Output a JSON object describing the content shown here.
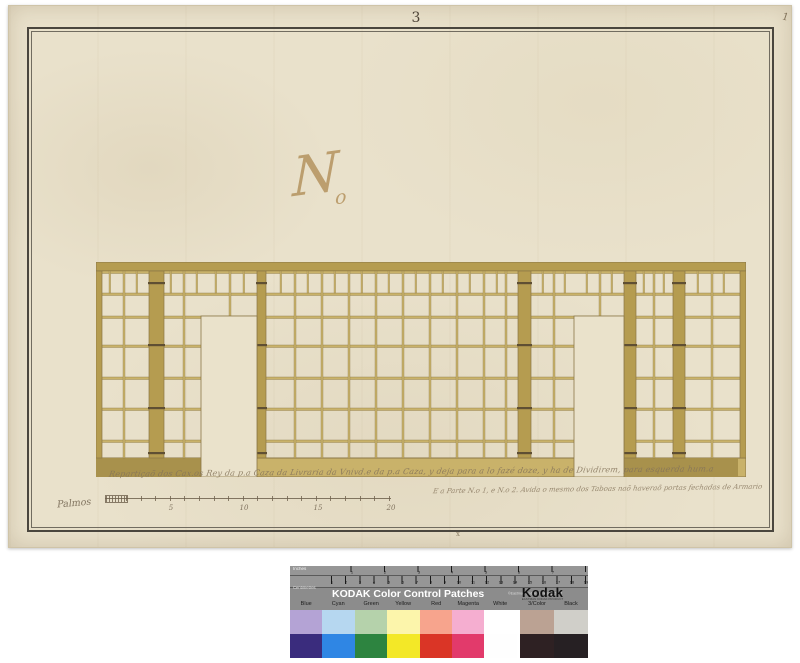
{
  "paper": {
    "page_number": "3",
    "corner_mark": "1",
    "monogram": {
      "main": "N",
      "sub": "o"
    },
    "caption_line1": "Repartiçaõ dos Cax.os Rey da p.a Caza da Livraria da Vnivd.e da p.a Caza, y deja para a lo fazé doze, y ha de Dividirem, para esquerda hum.a",
    "caption_line2": "E a Parte N.o 1, e N.o 2. Avida o mesmo dos Taboas naõ haveraõ portas fechadas de Armario",
    "bottom_mark": "x"
  },
  "scale_bar": {
    "label": "Palmos",
    "x0": 96,
    "x1": 382,
    "y": 492,
    "hatch": [
      96,
      117
    ],
    "tick_start": 117,
    "tick_spacing": 14.6,
    "numbers": [
      [
        "5",
        162
      ],
      [
        "10",
        235
      ],
      [
        "15",
        309
      ],
      [
        "20",
        382
      ]
    ]
  },
  "drawing": {
    "w": 650,
    "h": 215,
    "paper": "#eae2cb",
    "line": "#8a7747",
    "tan": "#c9b26a",
    "tan_dark": "#b59c50",
    "tan_deep": "#a8914c",
    "hinge": "#5f4f33",
    "cornice": [
      0,
      0,
      650,
      9
    ],
    "plinth": [
      0,
      196,
      650,
      19
    ],
    "plinth_dark": [
      [
        0,
        110
      ],
      [
        528,
        114
      ]
    ],
    "rails": [
      9,
      31,
      54,
      83,
      115,
      146,
      178
    ],
    "posts": [
      [
        0,
        6
      ],
      [
        53,
        15
      ],
      [
        161,
        9
      ],
      [
        422,
        13
      ],
      [
        528,
        12
      ],
      [
        577,
        12
      ],
      [
        644,
        6
      ]
    ],
    "mullions": [
      27,
      87,
      198,
      225,
      252,
      279,
      306,
      333,
      360,
      387,
      409,
      457,
      557,
      615
    ],
    "upper_mullions": [
      133,
      503
    ],
    "frieze": [
      13,
      40,
      74,
      100,
      119,
      147,
      184,
      211,
      238,
      265,
      292,
      319,
      346,
      373,
      400,
      446,
      468,
      490,
      515,
      547,
      567,
      601,
      627
    ],
    "doors": [
      [
        105,
        54,
        56,
        161
      ],
      [
        478,
        54,
        50,
        161
      ]
    ],
    "hinge_y": [
      20,
      82,
      145,
      190
    ]
  },
  "kodak": {
    "title": "KODAK Color Control Patches",
    "copyright": "©Eastman Kodak Company, 2007",
    "brand": "Kodak",
    "brand_sub": "EASTMAN KODAK PRODUCT",
    "ruler_top_label": "Inches",
    "ruler_bottom_label": "Centimetres",
    "inch_numbers": [
      "1",
      "2",
      "3",
      "4",
      "5",
      "6",
      "7"
    ],
    "cm_numbers": [
      "1",
      "2",
      "3",
      "4",
      "5",
      "6",
      "7",
      "8",
      "9",
      "10",
      "11",
      "12",
      "13",
      "14",
      "15",
      "16",
      "17",
      "18",
      "19"
    ],
    "ruler_origin": 28,
    "inch_spacing": 33.5,
    "cm_spacing": 14.1,
    "columns": [
      {
        "label": "Blue",
        "light": "#b4a3d5",
        "dark": "#3a2c7d",
        "w": 32.4
      },
      {
        "label": "Cyan",
        "light": "#b6d7f0",
        "dark": "#2f86e4",
        "w": 32.4
      },
      {
        "label": "Green",
        "light": "#b5d2ab",
        "dark": "#2d8440",
        "w": 32.4
      },
      {
        "label": "Yellow",
        "light": "#fcf5ab",
        "dark": "#f3e827",
        "w": 32.4
      },
      {
        "label": "Red",
        "light": "#f7a48d",
        "dark": "#da3526",
        "w": 32.4
      },
      {
        "label": "Magenta",
        "light": "#f5aed0",
        "dark": "#e23a6b",
        "w": 32.4
      },
      {
        "label": "White",
        "light": "#ffffff",
        "dark": "#fefefe",
        "w": 32.4
      },
      {
        "label": "gap",
        "light": "",
        "dark": "",
        "w": 3
      },
      {
        "label": "3/Color",
        "light": "#bba293",
        "dark": "#2e2123",
        "w": 34
      },
      {
        "label": "Black",
        "light": "#d0cfc9",
        "dark": "#262023",
        "w": 34
      }
    ]
  }
}
